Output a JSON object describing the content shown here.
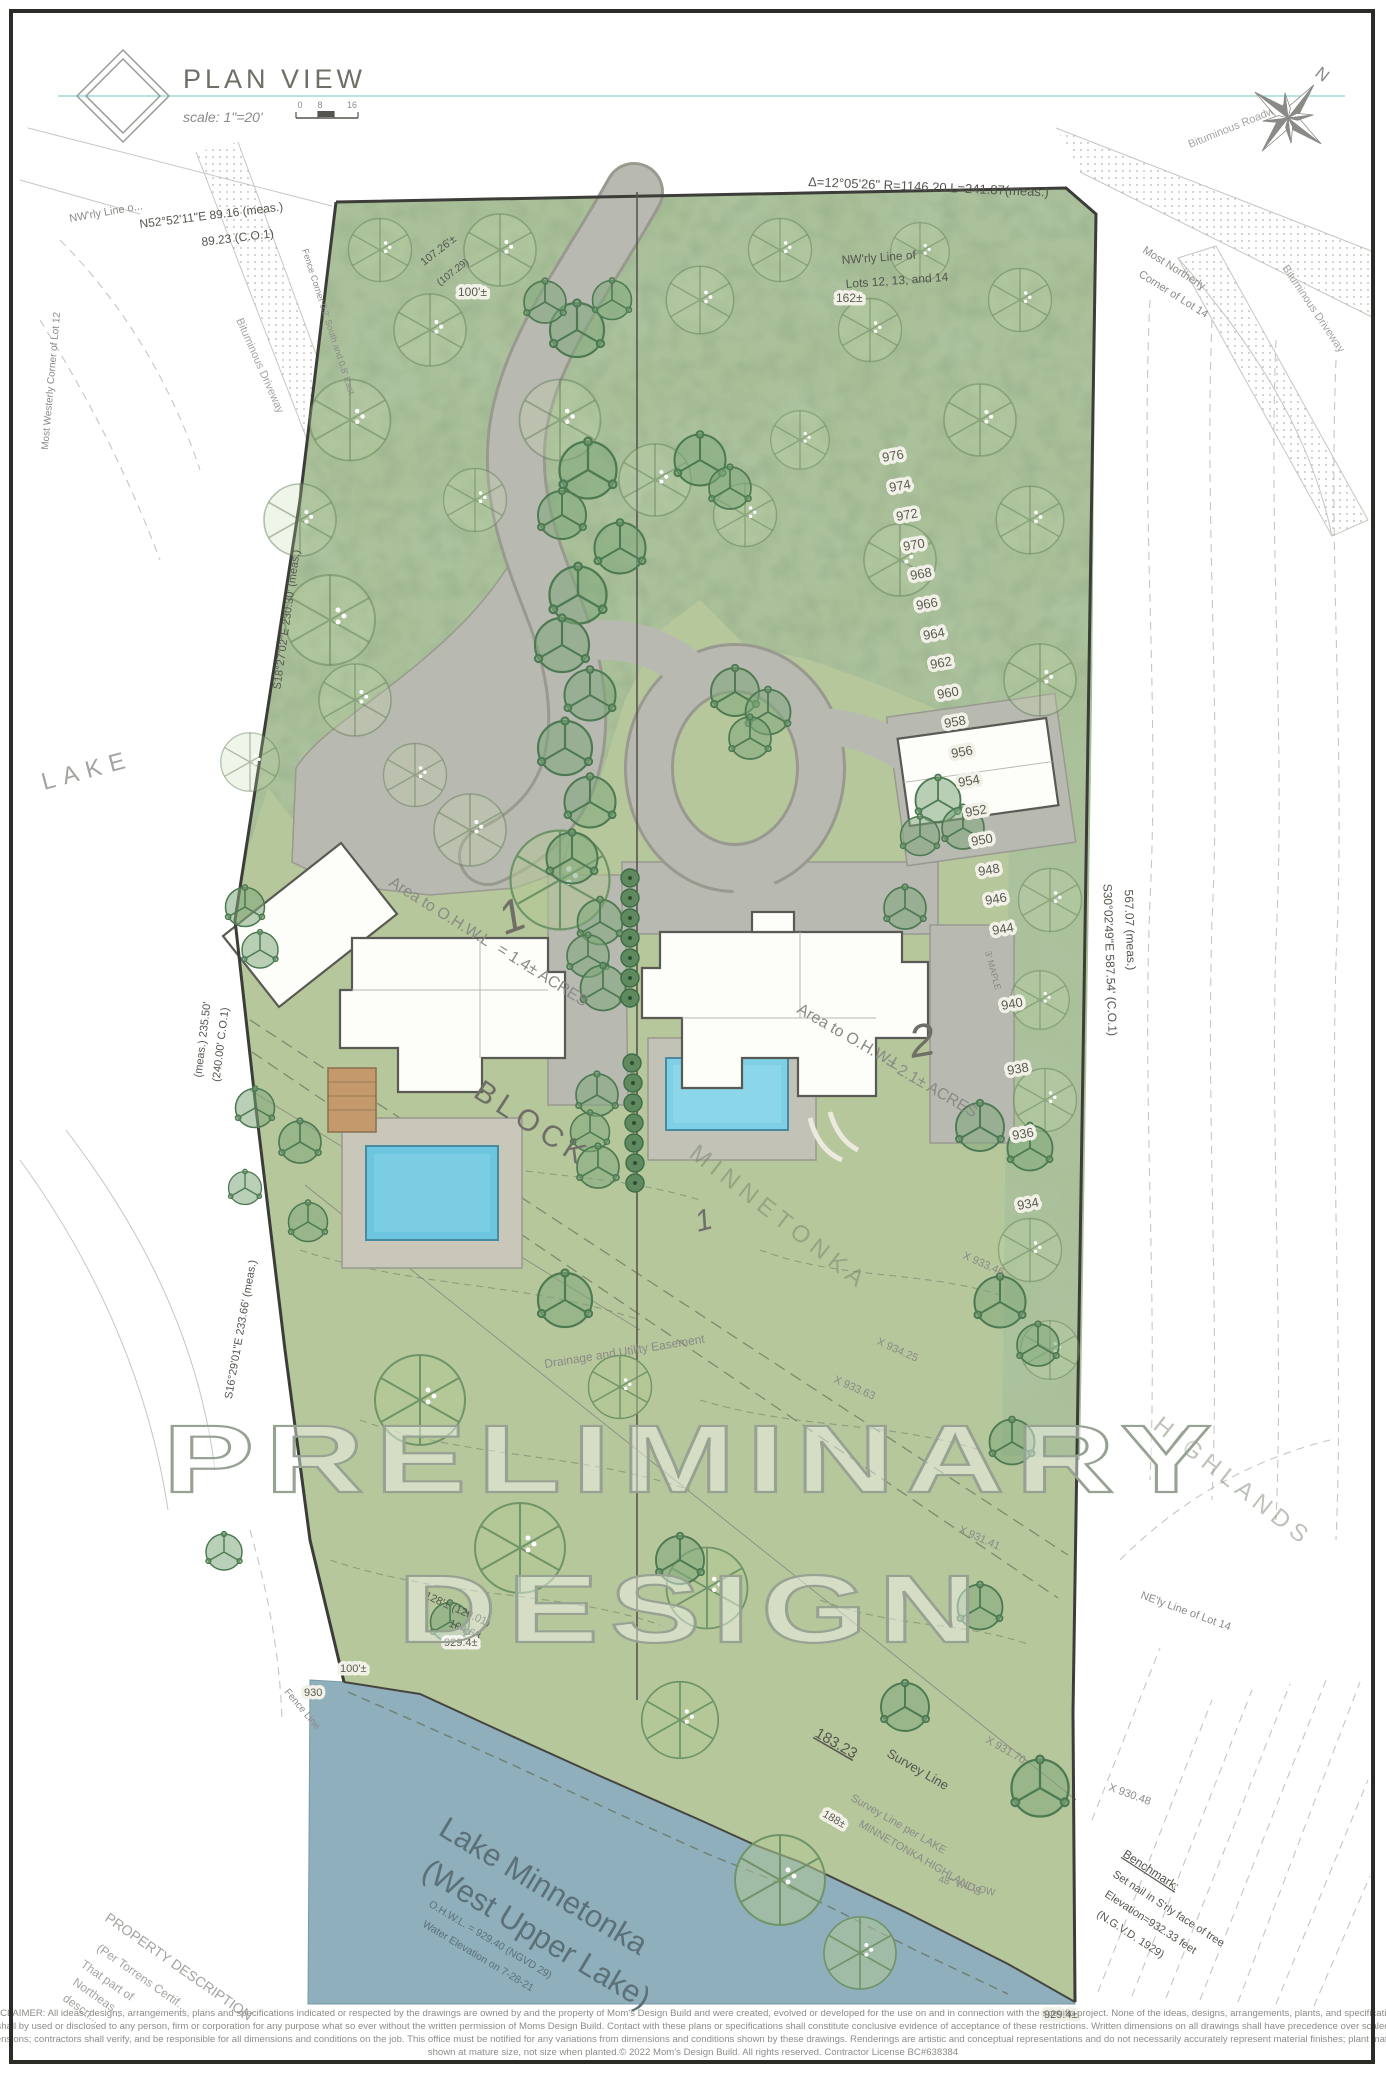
{
  "header": {
    "title": "PLAN VIEW",
    "scale": "scale: 1\"=20'",
    "tick0": "0",
    "tick8": "8",
    "tick16": "16",
    "north": "N"
  },
  "watermark": {
    "line1": "PRELIMINARY",
    "line2": "DESIGN"
  },
  "lots": {
    "block": "BLOCK",
    "lot1": "1",
    "lot1b": "1",
    "lot2": "2",
    "area1a": "Area to O.H.W.L",
    "area1b": "= 1.4± ACRES",
    "area2a": "Area to O.H.W.L",
    "area2b": "= 2.1± ACRES"
  },
  "contours": {
    "chain": [
      "976",
      "974",
      "972",
      "970",
      "968",
      "966",
      "964",
      "962",
      "960",
      "958",
      "956",
      "954",
      "952",
      "950",
      "948",
      "946",
      "944"
    ],
    "lower": [
      "940",
      "938",
      "936",
      "934"
    ]
  },
  "dims": {
    "d162": "162±",
    "d100a": "100'±",
    "d100b": "100'±",
    "d128": "128'± (129.01)",
    "d10468": "104.68",
    "d9294a": "929.4±",
    "d930": "930",
    "d9294b": "929.4±",
    "d18323": "183.23",
    "d188": "188±",
    "d10726": "107.26'±",
    "d10729": "(107.29)"
  },
  "survey": {
    "nwrly_line": "NW'rly Line o...",
    "n52": "N52°52'11\"E 89.16 (meas.)",
    "n52b": "89.23 (C.O.1)",
    "most_westerly": "Most Westerly Corner of Lot 12",
    "bit_drive_left": "Bituminous Driveway",
    "fence_corner": "Fence Corner 0.2' South and 0.8' East",
    "delta": "Δ=12°05'26\"  R=1146.20  L=241.87(meas.)",
    "nw_lots1": "NW'rly Line of",
    "nw_lots2": "Lots 12, 13, and 14",
    "most_northerly1": "Most Northerly",
    "most_northerly2": "Corner of Lot 14",
    "bit_road": "Bituminous Roadway",
    "bit_drive_right": "Bituminous Driveway",
    "lake_left": "LAKE",
    "s18": "S18°27'02\"E 230.30' (meas.)",
    "meas235": "(meas.) 235.50'",
    "c240": "(240.00' C.O.1)",
    "s16": "S16°29'01\"E 233.66' (meas.)",
    "s30a": "S30°02'49\"E 587.54' (C.O.1)",
    "s30b": "567.07 (meas.)",
    "easement": "Drainage and Utility Easement",
    "minnetonka": "MINNETONKA",
    "highlands": "HIGHLANDS",
    "x93363": "X 933.63",
    "x93425": "X 934.25",
    "x93346": "X 933.46",
    "x93141": "X 931.41",
    "x93170": "X 931.70",
    "x93048": "X 930.48",
    "neline": "NE'ly Line of Lot 14",
    "surveyline": "Survey Line",
    "surveyper1": "Survey Line per LAKE",
    "surveyper2": "MINNETONKA HIGHLANDS",
    "willow": "48\" WILLOW",
    "maple": "3' MAPLE",
    "bench1": "Benchmark:",
    "bench2": "Set nail in S'rly face of tree",
    "bench3": "Elevation=932.33 feet",
    "bench4": "(N.G.V.D. 1929)",
    "fence_line": "Fence Line",
    "prop1": "PROPERTY DESCRIPTION",
    "prop2": "(Per Torrens Certif...",
    "prop3": "That part of",
    "prop4": "Northeas...",
    "prop5": "descri..."
  },
  "lake": {
    "name1": "Lake Minnetonka",
    "name2": "(West Upper Lake)",
    "ohwl": "O.H.W.L. = 929.40 (NGVD 29)",
    "elev": "Water Elevation on 7-28-21"
  },
  "disclaimer": {
    "l1": "DISCLAIMER: All ideas, designs, arrangements, plans and specifications indicated or respected by the drawings are owned by and the property of Mom's Design Build and were created, evolved or developed for the use on and in connection with the specific project. None of the ideas, designs, arrangements, plants, and specifications",
    "l2": "shall by used or disclosed to any person, firm or corporation for any purpose what so ever without the written permission of Moms Design Build. Contact with these plans or specifications shall constitute conclusive evidence of acceptance of these restrictions. Written dimensions on all drawings shall have precedence over scaled",
    "l3": "dimensions; contractors shall verify, and be responsible for all dimensions and conditions on the job. This office must be notified for any variations from dimensions and conditions shown by these drawings. Renderings are artistic and conceptual representations and do not necessarily accurately represent material finishes; plant material",
    "l4": "shown at mature size, not size when planted.© 2022 Mom's Design Build. All rights reserved. Contractor License BC#638384"
  },
  "colors": {
    "site_green": "#b7c79c",
    "forest_green": "#a9bf97",
    "lake_blue": "#8fafbc",
    "pool_water": "#6cc6e0",
    "road_gray": "#b8b9b1",
    "accent_teal": "#8ed2cd"
  }
}
